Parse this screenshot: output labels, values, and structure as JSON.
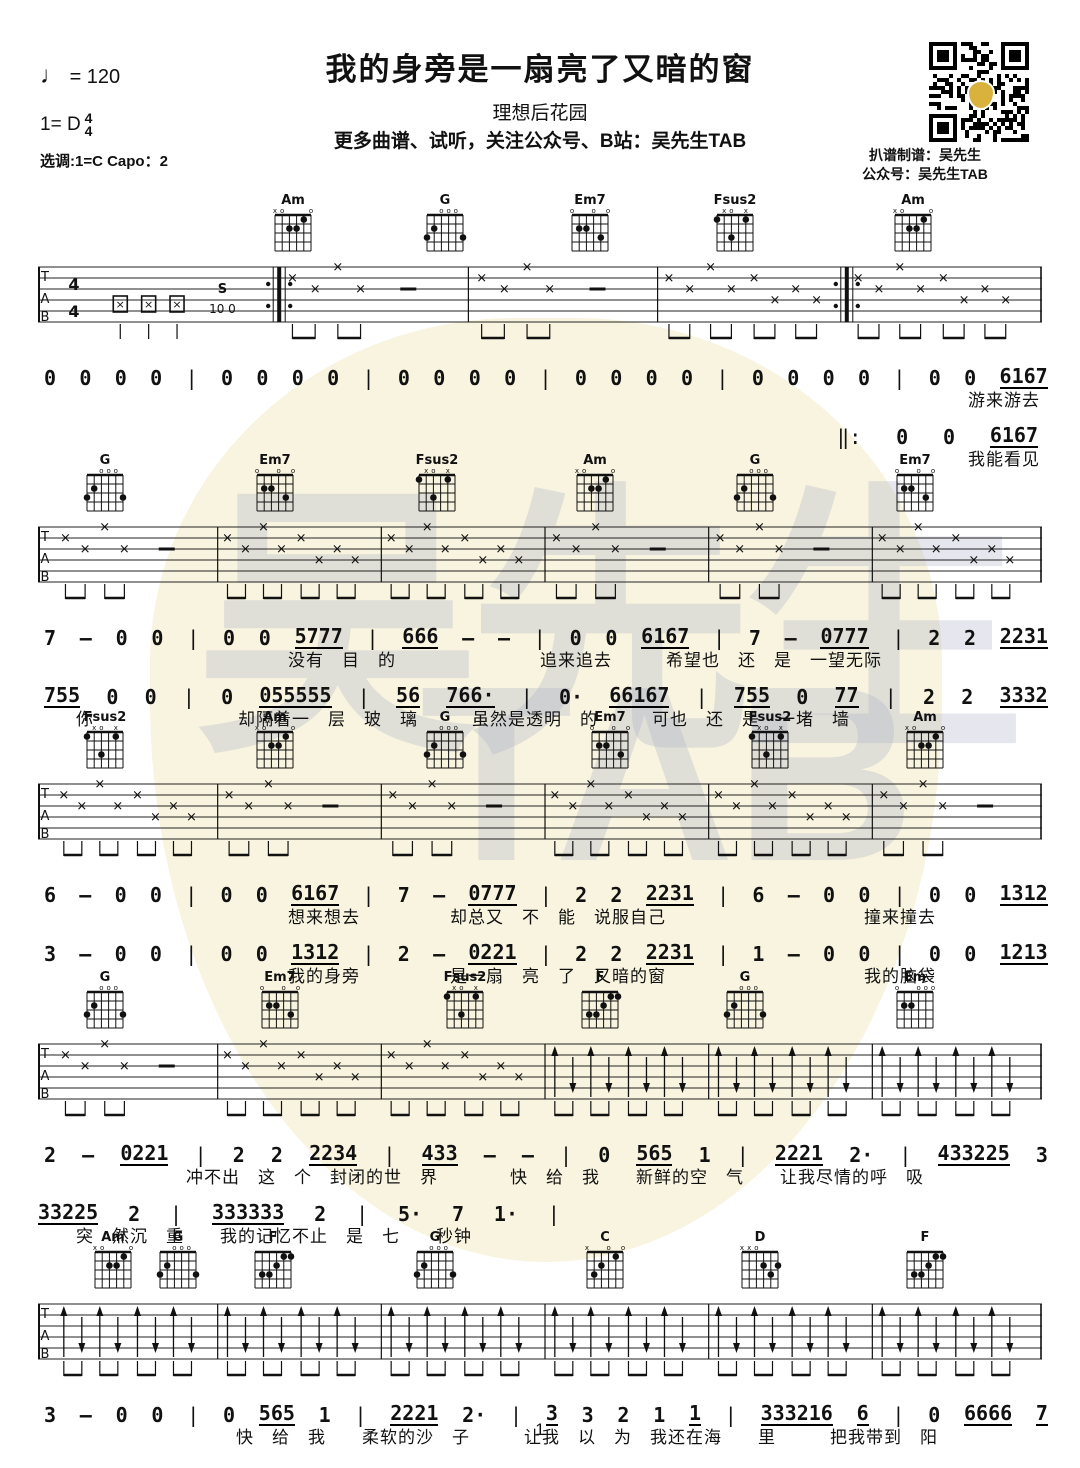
{
  "header": {
    "tempo_note": "♩",
    "tempo_value": "= 120",
    "key_label": "1= D",
    "time_top": "4",
    "time_bottom": "4",
    "tuning_line": "选调:1=C   Capo：2",
    "title": "我的身旁是一扇亮了又暗的窗",
    "subtitle": "理想后花园",
    "promo": "更多曲谱、试听，关注公众号、B站：吴先生TAB",
    "credit_line1": "扒谱制谱：吴先生",
    "credit_line2": "公众号：吴先生TAB"
  },
  "watermark": {
    "text1": "吴先生",
    "text2": "TAB",
    "pick_color": "#f9f4df",
    "glyph_color": "#aab0c8",
    "qr_pick_color": "#d8b23c"
  },
  "page_number": "1",
  "chord_shapes": {
    "Am": {
      "markers": [
        "x",
        "o",
        "",
        "",
        "",
        "o"
      ],
      "dots": [
        [
          2,
          2
        ],
        [
          3,
          2
        ],
        [
          4,
          1
        ]
      ]
    },
    "G": {
      "markers": [
        "",
        "",
        "o",
        "o",
        "o",
        ""
      ],
      "dots": [
        [
          0,
          3
        ],
        [
          1,
          2
        ],
        [
          5,
          3
        ]
      ]
    },
    "Em7": {
      "markers": [
        "o",
        "",
        "",
        "o",
        "",
        "o"
      ],
      "dots": [
        [
          1,
          2
        ],
        [
          2,
          2
        ],
        [
          4,
          3
        ]
      ]
    },
    "Fsus2": {
      "markers": [
        "",
        "x",
        "o",
        "",
        "x",
        ""
      ],
      "dots": [
        [
          0,
          1
        ],
        [
          4,
          1
        ],
        [
          2,
          3
        ]
      ]
    },
    "F": {
      "markers": [
        "",
        "",
        "",
        "",
        "",
        ""
      ],
      "dots": [
        [
          4,
          1
        ],
        [
          5,
          1
        ],
        [
          3,
          2
        ],
        [
          1,
          3
        ],
        [
          2,
          3
        ]
      ]
    },
    "Em": {
      "markers": [
        "o",
        "",
        "",
        "o",
        "o",
        "o"
      ],
      "dots": [
        [
          1,
          2
        ],
        [
          2,
          2
        ]
      ]
    },
    "C": {
      "markers": [
        "x",
        "",
        "",
        "o",
        "",
        "o"
      ],
      "dots": [
        [
          1,
          3
        ],
        [
          2,
          2
        ],
        [
          4,
          1
        ]
      ]
    },
    "D": {
      "markers": [
        "x",
        "x",
        "o",
        "",
        "",
        ""
      ],
      "dots": [
        [
          3,
          2
        ],
        [
          5,
          2
        ],
        [
          4,
          3
        ]
      ]
    }
  },
  "intro": {
    "slide_label": "S",
    "slide_notes": "10 0"
  },
  "systems": [
    {
      "top": 193,
      "chords": [
        {
          "name": "Am",
          "x": 230
        },
        {
          "name": "G",
          "x": 382
        },
        {
          "name": "Em7",
          "x": 527
        },
        {
          "name": "Fsus2",
          "x": 672
        },
        {
          "name": "Am",
          "x": 850
        }
      ],
      "staff": {
        "measures": [
          "mute",
          "x4dash",
          "x4dash",
          "x8",
          "x8"
        ],
        "time_sig": true,
        "repeat_after": [
          0,
          3
        ]
      },
      "lines": [
        {
          "tokens": [
            "0",
            "0",
            "0",
            "0",
            "|",
            "0",
            "0",
            "0",
            "0",
            "|",
            "0",
            "0",
            "0",
            "0",
            "|",
            "0",
            "0",
            "0",
            "0",
            "|",
            "0",
            "0",
            "0",
            "0",
            "|",
            "0",
            "0",
            "_6167"
          ],
          "side": "full",
          "wfrac": 1,
          "lyrics": "游来游去",
          "lyr_side": "right",
          "lyr_indent": 0
        },
        {
          "tokens": [
            "‖:",
            "0",
            "0",
            "_6167"
          ],
          "side": "right",
          "wfrac": 0.2,
          "lyrics": "我能看见",
          "lyr_side": "right",
          "lyr_indent": 0
        }
      ]
    },
    {
      "top": 453,
      "chords": [
        {
          "name": "G",
          "x": 42
        },
        {
          "name": "Em7",
          "x": 212
        },
        {
          "name": "Fsus2",
          "x": 374
        },
        {
          "name": "Am",
          "x": 532
        },
        {
          "name": "G",
          "x": 692
        },
        {
          "name": "Em7",
          "x": 852
        }
      ],
      "staff": {
        "measures": [
          "x4dash",
          "x8",
          "x8",
          "x4dash",
          "x4dash",
          "x8"
        ],
        "time_sig": false,
        "repeat_after": []
      },
      "lines": [
        {
          "tokens": [
            "7",
            "–",
            "0",
            "0",
            "|",
            "0",
            "0",
            "_5777",
            "|",
            "_666",
            "–",
            "–",
            "|",
            "0",
            "0",
            "_6167",
            "|",
            "7",
            "–",
            "_0777",
            "|",
            "2",
            "2",
            "_2231"
          ],
          "side": "full",
          "wfrac": 1,
          "lyrics": "没有　目　的　　　　　　　　追来追去　　　希望也　还　是　一望无际",
          "lyr_side": "left",
          "lyr_indent": 250
        },
        {
          "tokens": [
            "_755",
            "0",
            "0",
            "|",
            "0",
            "_055555",
            "|",
            "_56",
            "_766·",
            "|",
            "0·",
            "_66167",
            "|",
            "_755",
            "0",
            "_77",
            "|",
            "2",
            "2",
            "_3332"
          ],
          "side": "full",
          "wfrac": 1,
          "lyrics": "你　　　　　　　　却隔着一　层　玻　璃　　　虽然是透明　的　　　可也　还　是　一堵　墙",
          "lyr_side": "left",
          "lyr_indent": 38
        }
      ]
    },
    {
      "top": 710,
      "chords": [
        {
          "name": "Fsus2",
          "x": 42
        },
        {
          "name": "Am",
          "x": 212
        },
        {
          "name": "G",
          "x": 382
        },
        {
          "name": "Em7",
          "x": 547
        },
        {
          "name": "Fsus2",
          "x": 707
        },
        {
          "name": "Am",
          "x": 862
        }
      ],
      "staff": {
        "measures": [
          "x8",
          "x4dash",
          "x4dash",
          "x8",
          "x8",
          "x4dash"
        ],
        "time_sig": false,
        "repeat_after": []
      },
      "lines": [
        {
          "tokens": [
            "6",
            "–",
            "0",
            "0",
            "|",
            "0",
            "0",
            "_6167",
            "|",
            "7",
            "–",
            "_0777",
            "|",
            "2",
            "2",
            "_2231",
            "|",
            "6",
            "–",
            "0",
            "0",
            "|",
            "0",
            "0",
            "_1312"
          ],
          "side": "full",
          "wfrac": 1,
          "lyrics": "想来想去　　　　　却总又　不　能　说服自己　　　　　　　　　　　撞来撞去",
          "lyr_side": "left",
          "lyr_indent": 250
        },
        {
          "tokens": [
            "3",
            "–",
            "0",
            "0",
            "|",
            "0",
            "0",
            "_1312",
            "|",
            "2",
            "–",
            "_0221",
            "|",
            "2",
            "2",
            "_2231",
            "|",
            "1",
            "–",
            "0",
            "0",
            "|",
            "0",
            "0",
            "_1213"
          ],
          "side": "full",
          "wfrac": 1,
          "lyrics": "我的身旁　　　　　是一扇　亮　了　又暗的窗　　　　　　　　　　　我的脑袋",
          "lyr_side": "left",
          "lyr_indent": 250
        }
      ]
    },
    {
      "top": 970,
      "chords": [
        {
          "name": "G",
          "x": 42
        },
        {
          "name": "Em7",
          "x": 217
        },
        {
          "name": "Fsus2",
          "x": 402
        },
        {
          "name": "F",
          "x": 537
        },
        {
          "name": "G",
          "x": 682
        },
        {
          "name": "Em",
          "x": 852
        }
      ],
      "staff": {
        "measures": [
          "x4dash",
          "x8",
          "x8",
          "arrow8",
          "arrow8",
          "arrow8"
        ],
        "time_sig": false,
        "repeat_after": []
      },
      "lines": [
        {
          "tokens": [
            "2",
            "–",
            "_0221",
            "|",
            "2",
            "2",
            "_2234",
            "|",
            "_433",
            "–",
            "–",
            "|",
            "0",
            "_565",
            "1",
            "|",
            "_2221",
            "2·",
            "|",
            "_433225",
            "3"
          ],
          "side": "full",
          "wfrac": 1,
          "lyrics": "冲不出　这　个　封闭的世　界　　　　快　给　我　　新鲜的空　气　　让我尽情的呼　吸",
          "lyr_side": "left",
          "lyr_indent": 148
        },
        {
          "tokens": [
            "_33225",
            "2",
            "|",
            "_333333",
            "2",
            "|",
            "5·",
            "7",
            "1·",
            "|"
          ],
          "side": "left",
          "wfrac": 0.52,
          "lyrics": "突　然沉　重　　我的记忆不止　是　七　　秒钟",
          "lyr_side": "left",
          "lyr_indent": 38
        }
      ]
    },
    {
      "top": 1230,
      "chords": [
        {
          "name": "Am",
          "x": 50
        },
        {
          "name": "G",
          "x": 115
        },
        {
          "name": "F",
          "x": 210
        },
        {
          "name": "G",
          "x": 372
        },
        {
          "name": "C",
          "x": 542
        },
        {
          "name": "D",
          "x": 697
        },
        {
          "name": "F",
          "x": 862
        }
      ],
      "staff": {
        "measures": [
          "arrow8",
          "arrow8",
          "arrow8",
          "arrow8",
          "arrow8",
          "arrow8"
        ],
        "time_sig": false,
        "repeat_after": []
      },
      "lines": [
        {
          "tokens": [
            "3",
            "–",
            "0",
            "0",
            "|",
            "0",
            "_565",
            "1",
            "|",
            "_2221",
            "2·",
            "|",
            "_3",
            "3",
            "2",
            "1",
            "_1",
            "|",
            "_333216",
            "_6",
            "|",
            "0",
            "_6666",
            "_7"
          ],
          "side": "full",
          "wfrac": 1,
          "lyrics": "快　给　我　　柔软的沙　子　　　让我　以　为　我还在海　　里　　　把我带到　阳",
          "lyr_side": "left",
          "lyr_indent": 198
        }
      ]
    }
  ]
}
